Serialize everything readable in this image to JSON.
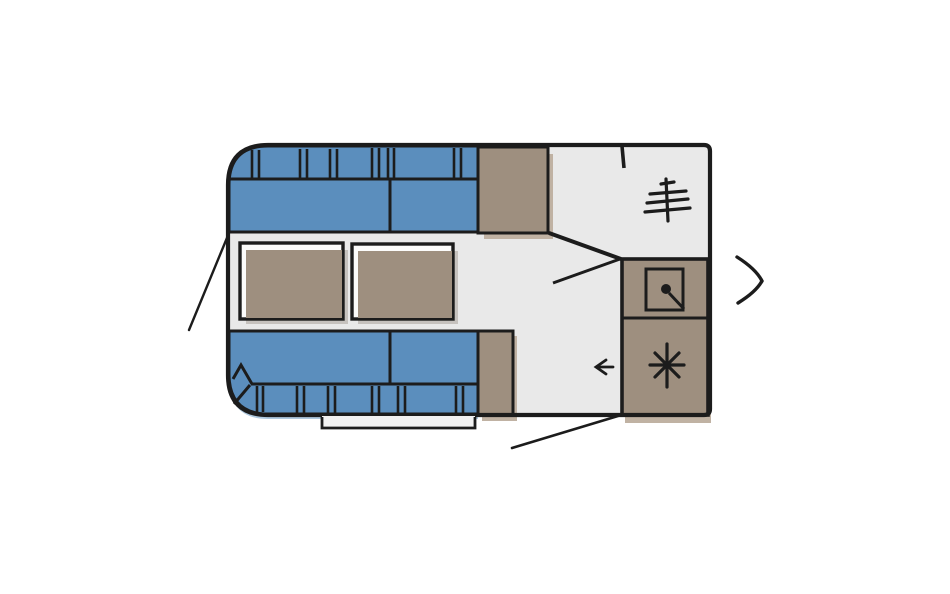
{
  "view": {
    "type": "caravan-floorplan-carousel-slide",
    "visible_text": ""
  },
  "colors": {
    "bg": "#ffffff",
    "floor": "#e9e9e9",
    "outline": "#1c1c1c",
    "blue": "#5b8ebd",
    "blue-shadow": "#aec8de",
    "tan": "#9e8f7f",
    "tan-shadow": "#c0b2a3",
    "table-shadow": "#a9a29a",
    "highlight": "#fbfbfa"
  },
  "floorplan": {
    "style": "hand-drawn sketch, top view",
    "regions": [
      "front-dinette-bench-top",
      "front-dinette-bench-bottom",
      "dinette-table-left",
      "dinette-table-right",
      "cabinet-top",
      "cabinet-bottom",
      "washroom",
      "kitchen-unit",
      "entry-area",
      "entry-step"
    ],
    "icons": {
      "washroom": "hanger-rail-icon",
      "kitchen_sink": "sink-basin-icon",
      "kitchen_stove": "stove-burner-icon",
      "entry": "entry-arrow-icon"
    },
    "annotations": [
      "pointer-line-front-dinette",
      "pointer-line-entry-door"
    ]
  },
  "carousel": {
    "next_control": "chevron-right-icon"
  }
}
